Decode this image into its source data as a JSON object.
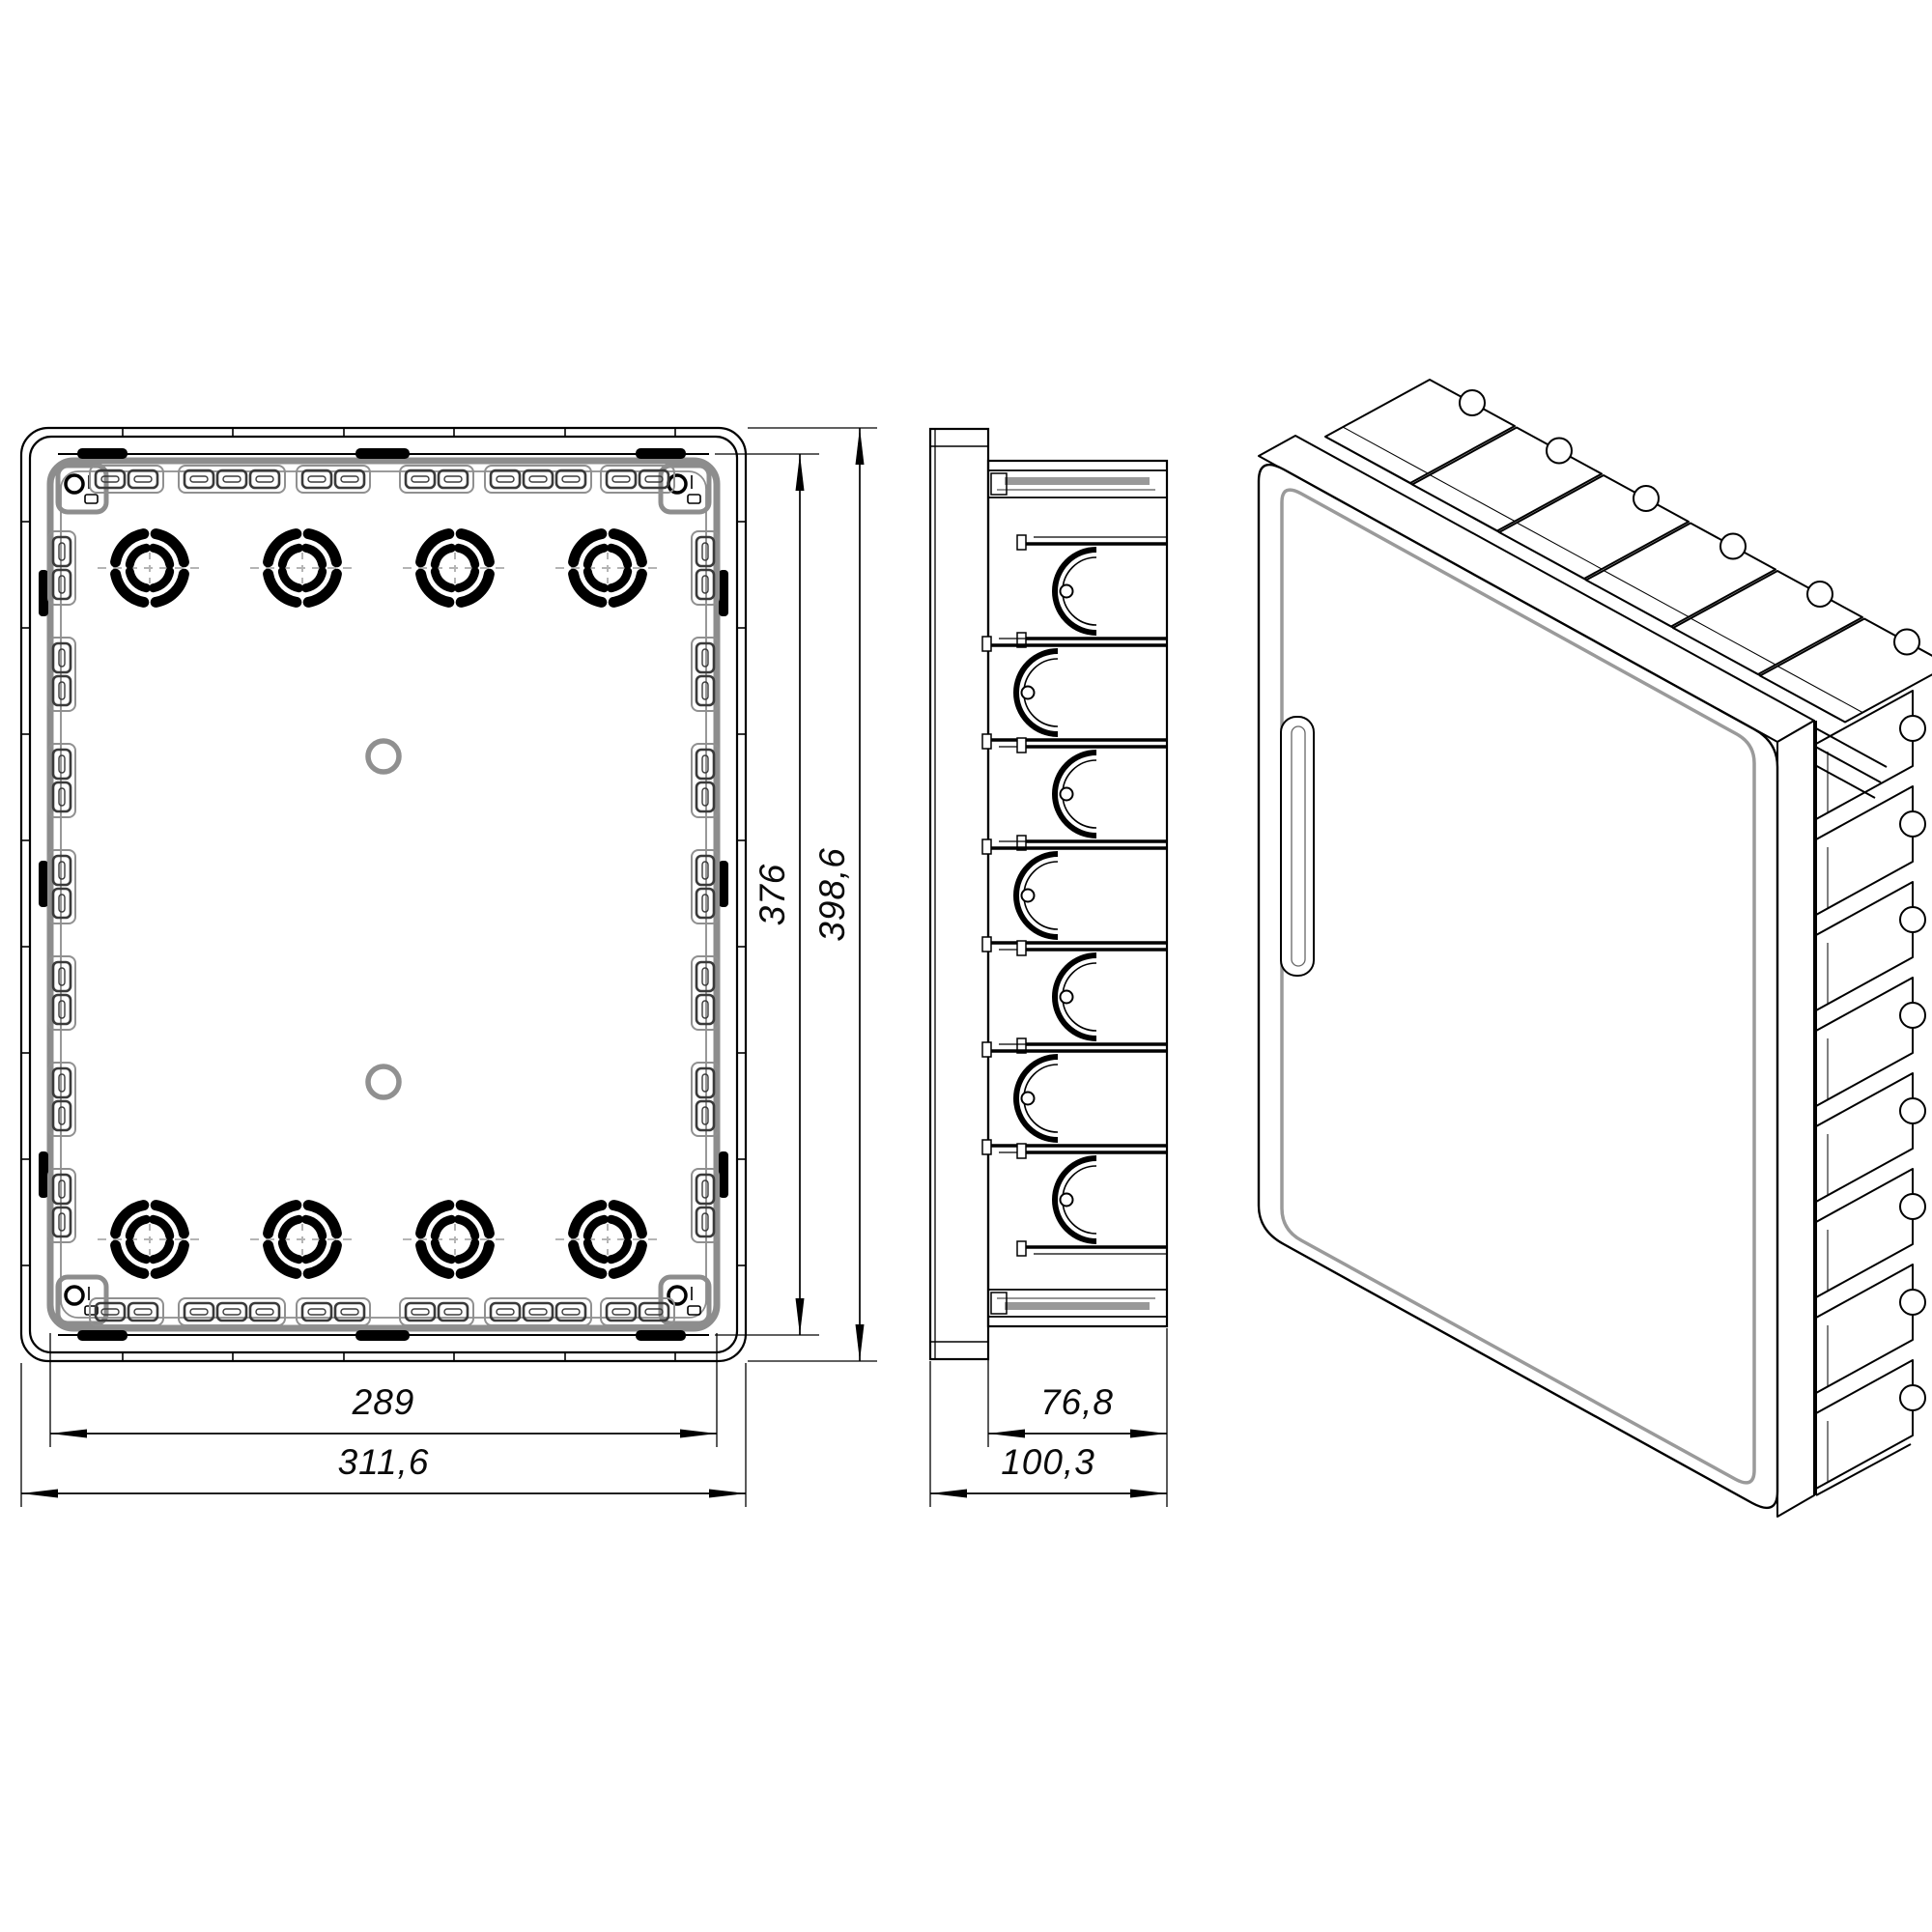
{
  "style": {
    "background": "#ffffff",
    "primary_line_color": "#000000",
    "secondary_line_color": "#8d8d8d",
    "centerline_color": "#b5b5b5"
  },
  "front_view": {
    "dim_inner_width": "289",
    "dim_outer_width": "311,6",
    "dim_inner_height": "376",
    "dim_outer_height": "398,6"
  },
  "side_view": {
    "dim_body_depth": "76,8",
    "dim_total_depth": "100,3"
  }
}
